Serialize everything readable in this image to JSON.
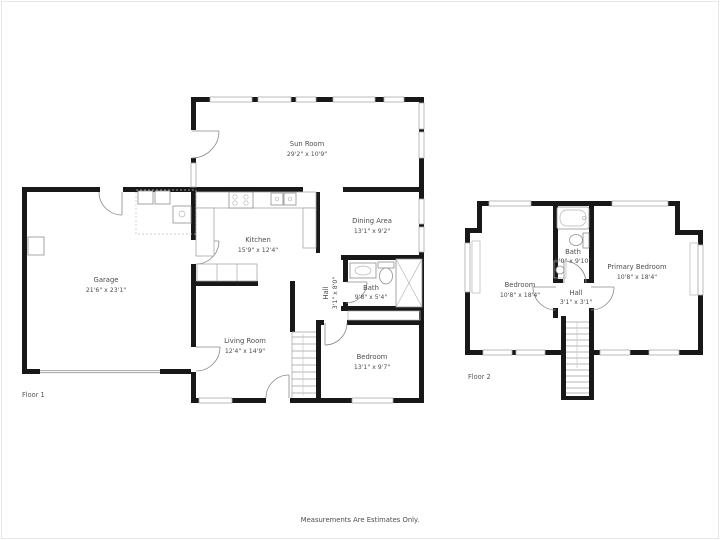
{
  "page": {
    "disclaimer": "Measurements Are Estimates Only.",
    "background": "#ffffff",
    "frame_color": "#e5e5e5"
  },
  "colors": {
    "wall": "#181818",
    "fixture_line": "#8f8f8f",
    "text": "#4d4d4d"
  },
  "floor1": {
    "label": "Floor 1",
    "rooms": [
      {
        "name": "Sun Room",
        "dims": "29'2\" x 10'9\""
      },
      {
        "name": "Kitchen",
        "dims": "15'9\" x 12'4\""
      },
      {
        "name": "Dining Area",
        "dims": "13'1\" x 9'2\""
      },
      {
        "name": "Garage",
        "dims": "21'6\" x 23'1\""
      },
      {
        "name": "Living Room",
        "dims": "12'4\" x 14'9\""
      },
      {
        "name": "Hall",
        "dims": "3'1\" x 8'0\""
      },
      {
        "name": "Bath",
        "dims": "9'8\" x 5'4\""
      },
      {
        "name": "Bedroom",
        "dims": "13'1\" x 9'7\""
      }
    ]
  },
  "floor2": {
    "label": "Floor 2",
    "rooms": [
      {
        "name": "Bedroom",
        "dims": "10'8\" x 18'4\""
      },
      {
        "name": "Bath",
        "dims": "5'0\" x 9'10\""
      },
      {
        "name": "Primary Bedroom",
        "dims": "10'8\" x 18'4\""
      },
      {
        "name": "Hall",
        "dims": "3'1\" x 3'1\""
      }
    ]
  }
}
